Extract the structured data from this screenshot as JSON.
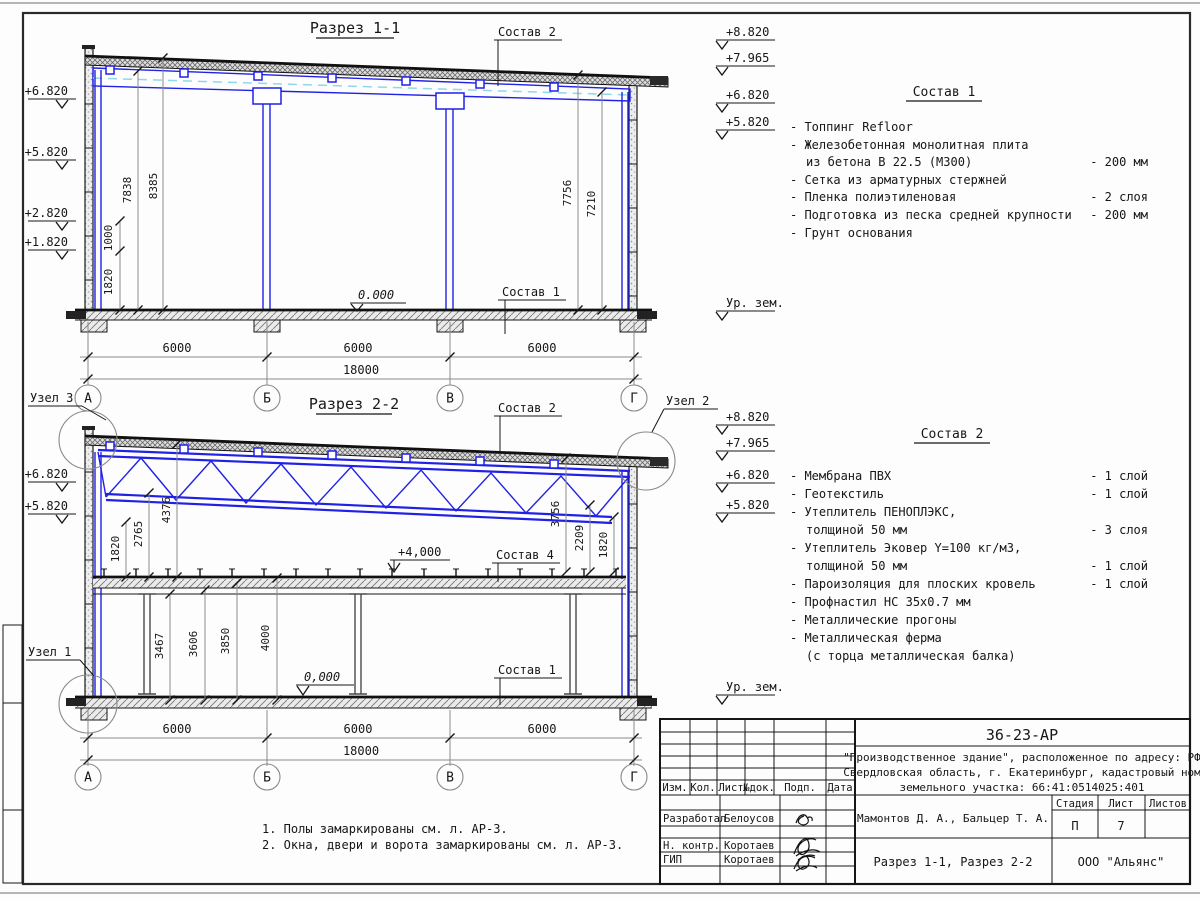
{
  "colors": {
    "structure_blue": "#2121e6",
    "centerline_cyan": "#8fd8ea",
    "line_black": "#161616",
    "dim_gray": "#8a8a8a"
  },
  "s1": {
    "title": "Разрез 1-1",
    "sostav2_label": "Состав 2",
    "sostav1_label": "Состав 1",
    "elev_left": [
      "+6.820",
      "+5.820",
      "+2.820",
      "+1.820"
    ],
    "elev_right": [
      "+8.820",
      "+7.965",
      "+6.820",
      "+5.820"
    ],
    "ground": "Ур. зем.",
    "zero": "0.000",
    "dim_left": [
      "7838",
      "8385",
      "1000",
      "1820"
    ],
    "dim_right": [
      "7756",
      "7210"
    ],
    "spans": [
      "6000",
      "6000",
      "6000"
    ],
    "total": "18000",
    "axes": [
      "А",
      "Б",
      "В",
      "Г"
    ]
  },
  "s2": {
    "title": "Разрез 2-2",
    "uzel1": "Узел 1",
    "uzel2": "Узел 2",
    "uzel3": "Узел 3",
    "sostav2_label": "Состав 2",
    "sostav4_label": "Состав 4",
    "sostav1_label": "Состав 1",
    "elev_left": [
      "+6.820",
      "+5.820"
    ],
    "elev_right": [
      "+8.820",
      "+7.965",
      "+6.820",
      "+5.820"
    ],
    "ground": "Ур. зем.",
    "level4": "+4,000",
    "zero": "0,000",
    "dim_left": [
      "1820",
      "2765",
      "4376"
    ],
    "dim_mid": [
      "3467",
      "3606",
      "3850",
      "4000"
    ],
    "dim_right": [
      "3756",
      "2209",
      "1820"
    ],
    "spans": [
      "6000",
      "6000",
      "6000"
    ],
    "total": "18000",
    "axes": [
      "А",
      "Б",
      "В",
      "Г"
    ]
  },
  "sostav1": {
    "title": "Состав 1",
    "items": [
      {
        "t": "- Топпинг Refloor",
        "v": ""
      },
      {
        "t": "- Железобетонная  монолитная плита",
        "v": ""
      },
      {
        "t": "из бетона В 22.5 (М300)",
        "v": "- 200 мм"
      },
      {
        "t": "- Сетка из арматурных стержней",
        "v": ""
      },
      {
        "t": "- Пленка полиэтиленовая",
        "v": "- 2 слоя"
      },
      {
        "t": "- Подготовка из песка средней крупности",
        "v": "- 200 мм"
      },
      {
        "t": "- Грунт основания",
        "v": ""
      }
    ]
  },
  "sostav2": {
    "title": "Состав 2",
    "items": [
      {
        "t": "- Мембрана ПВХ",
        "v": "- 1 слой"
      },
      {
        "t": "- Геотекстиль",
        "v": "- 1 слой"
      },
      {
        "t": "- Утеплитель ПЕНОПЛЭКС,",
        "v": ""
      },
      {
        "t": "толщиной 50 мм",
        "v": "- 3 слоя"
      },
      {
        "t": "- Утеплитель Эковер Y=100 кг/м3,",
        "v": ""
      },
      {
        "t": "толщиной 50 мм",
        "v": "- 1 слой"
      },
      {
        "t": "- Пароизоляция для плоских кровель",
        "v": "- 1 слой"
      },
      {
        "t": "- Профнастил НС 35х0.7 мм",
        "v": ""
      },
      {
        "t": "- Металлические прогоны",
        "v": ""
      },
      {
        "t": "- Металлическая ферма",
        "v": ""
      },
      {
        "t": "(с торца металлическая балка)",
        "v": ""
      }
    ]
  },
  "notes": [
    "1. Полы замаркированы см. л. АР-3.",
    "2. Окна, двери и ворота замаркированы см. л. АР-3."
  ],
  "titleblock": {
    "code": "36-23-АР",
    "desc1": "\"Производственное здание\", расположенное по адресу: РФ",
    "desc2": "Свердловская область, г. Екатеринбург, кадастровый ном",
    "desc3": "земельного участка: 66:41:0514025:401",
    "cols": [
      "Изм.",
      "Кол.",
      "Лист",
      "№док.",
      "Подп.",
      "Дата"
    ],
    "rows": [
      {
        "role": "Разработал",
        "name": "Белоусов"
      },
      {
        "role": "Н. контр.",
        "name": "Коротаев"
      },
      {
        "role": "ГИП",
        "name": "Коротаев"
      }
    ],
    "authors": "Мамонтов Д. А., Бальцер Т. А.",
    "stage_label": "Стадия",
    "sheet_label": "Лист",
    "sheets_label": "Листов",
    "stage": "П",
    "sheet": "7",
    "doc_title": "Разрез 1-1, Разрез 2-2",
    "company": "ООО \"Альянс\""
  }
}
